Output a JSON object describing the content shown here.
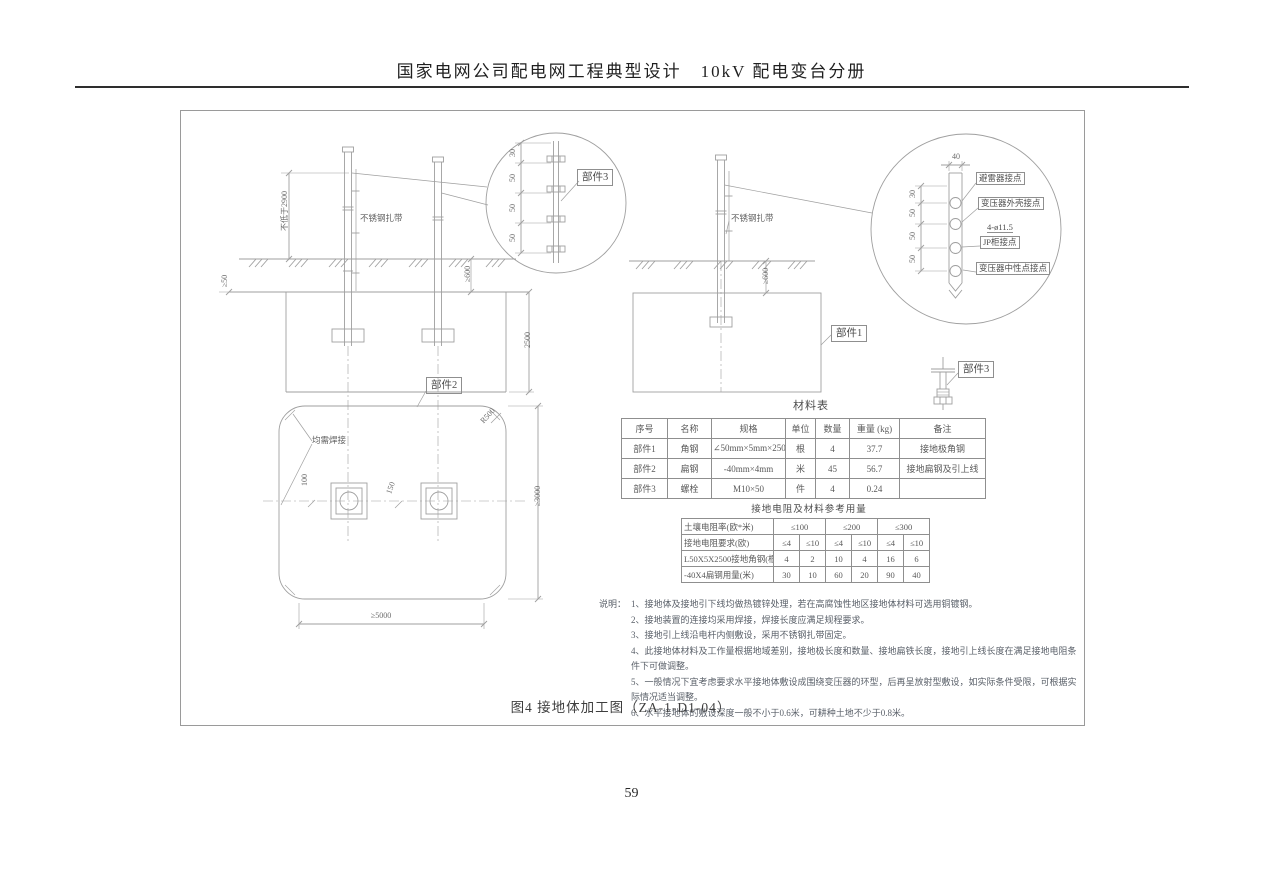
{
  "page": {
    "header_title": "国家电网公司配电网工程典型设计　10kV 配电变台分册",
    "page_number": "59"
  },
  "figure": {
    "caption": "图4 接地体加工图（ZA-1-D1-04）"
  },
  "labels": {
    "part1": "部件1",
    "part2": "部件2",
    "part3": "部件3",
    "stainless_tie": "不锈钢扎带",
    "weld_all": "均需焊接",
    "arrester_point": "避雷器接点",
    "transformer_shell_point": "变压器外壳接点",
    "holes_spec": "4-ø11.5",
    "jp_cabinet_point": "JP柜接点",
    "transformer_neutral_point": "变压器中性点接点"
  },
  "dims": {
    "min_2900": "不低于2900",
    "ge50": "≥50",
    "ge600": "≥600",
    "d2500": "2500",
    "ge3000": "≥3000",
    "ge5000": "≥5000",
    "d100": "100",
    "d150": "150",
    "d40": "40",
    "s30": "30",
    "s50": "50",
    "r500": "R500"
  },
  "material_table": {
    "title": "材料表",
    "headers": [
      "序号",
      "名称",
      "规格",
      "单位",
      "数量",
      "重量 (kg)",
      "备注"
    ],
    "rows": [
      [
        "部件1",
        "角钢",
        "∠50mm×5mm×2500mm",
        "根",
        "4",
        "37.7",
        "接地极角钢"
      ],
      [
        "部件2",
        "扁钢",
        "-40mm×4mm",
        "米",
        "45",
        "56.7",
        "接地扁钢及引上线"
      ],
      [
        "部件3",
        "螺栓",
        "M10×50",
        "件",
        "4",
        "0.24",
        ""
      ]
    ]
  },
  "resistance_table": {
    "title": "接地电阻及材料参考用量",
    "rows": [
      {
        "label": "土壤电阻率(欧*米)",
        "values": [
          "≤100",
          "≤200",
          "≤300"
        ]
      },
      {
        "label": "接地电阻要求(欧)",
        "values": [
          "≤4",
          "≤10",
          "≤4",
          "≤10",
          "≤4",
          "≤10"
        ]
      },
      {
        "label": "L50X5X2500接地角钢(根)",
        "values": [
          "4",
          "2",
          "10",
          "4",
          "16",
          "6"
        ]
      },
      {
        "label": "-40X4扁钢用量(米)",
        "values": [
          "30",
          "10",
          "60",
          "20",
          "90",
          "40"
        ]
      }
    ]
  },
  "notes": {
    "label": "说明：",
    "lines": [
      "1、接地体及接地引下线均做热镀锌处理，若在高腐蚀性地区接地体材料可选用铜镀钢。",
      "2、接地装置的连接均采用焊接，焊接长度应满足规程要求。",
      "3、接地引上线沿电杆内侧敷设，采用不锈钢扎带固定。",
      "4、此接地体材料及工作量根据地域差别，接地极长度和数量、接地扁铁长度，接地引上线长度在满足接地电阻条件下可做调整。",
      "5、一般情况下宜考虑要求水平接地体敷设成围绕变压器的环型，后再呈放射型敷设，如实际条件受限，可根据实际情况适当调整。",
      "6、水平接地体的敷设深度一般不小于0.6米，可耕种土地不少于0.8米。"
    ]
  }
}
